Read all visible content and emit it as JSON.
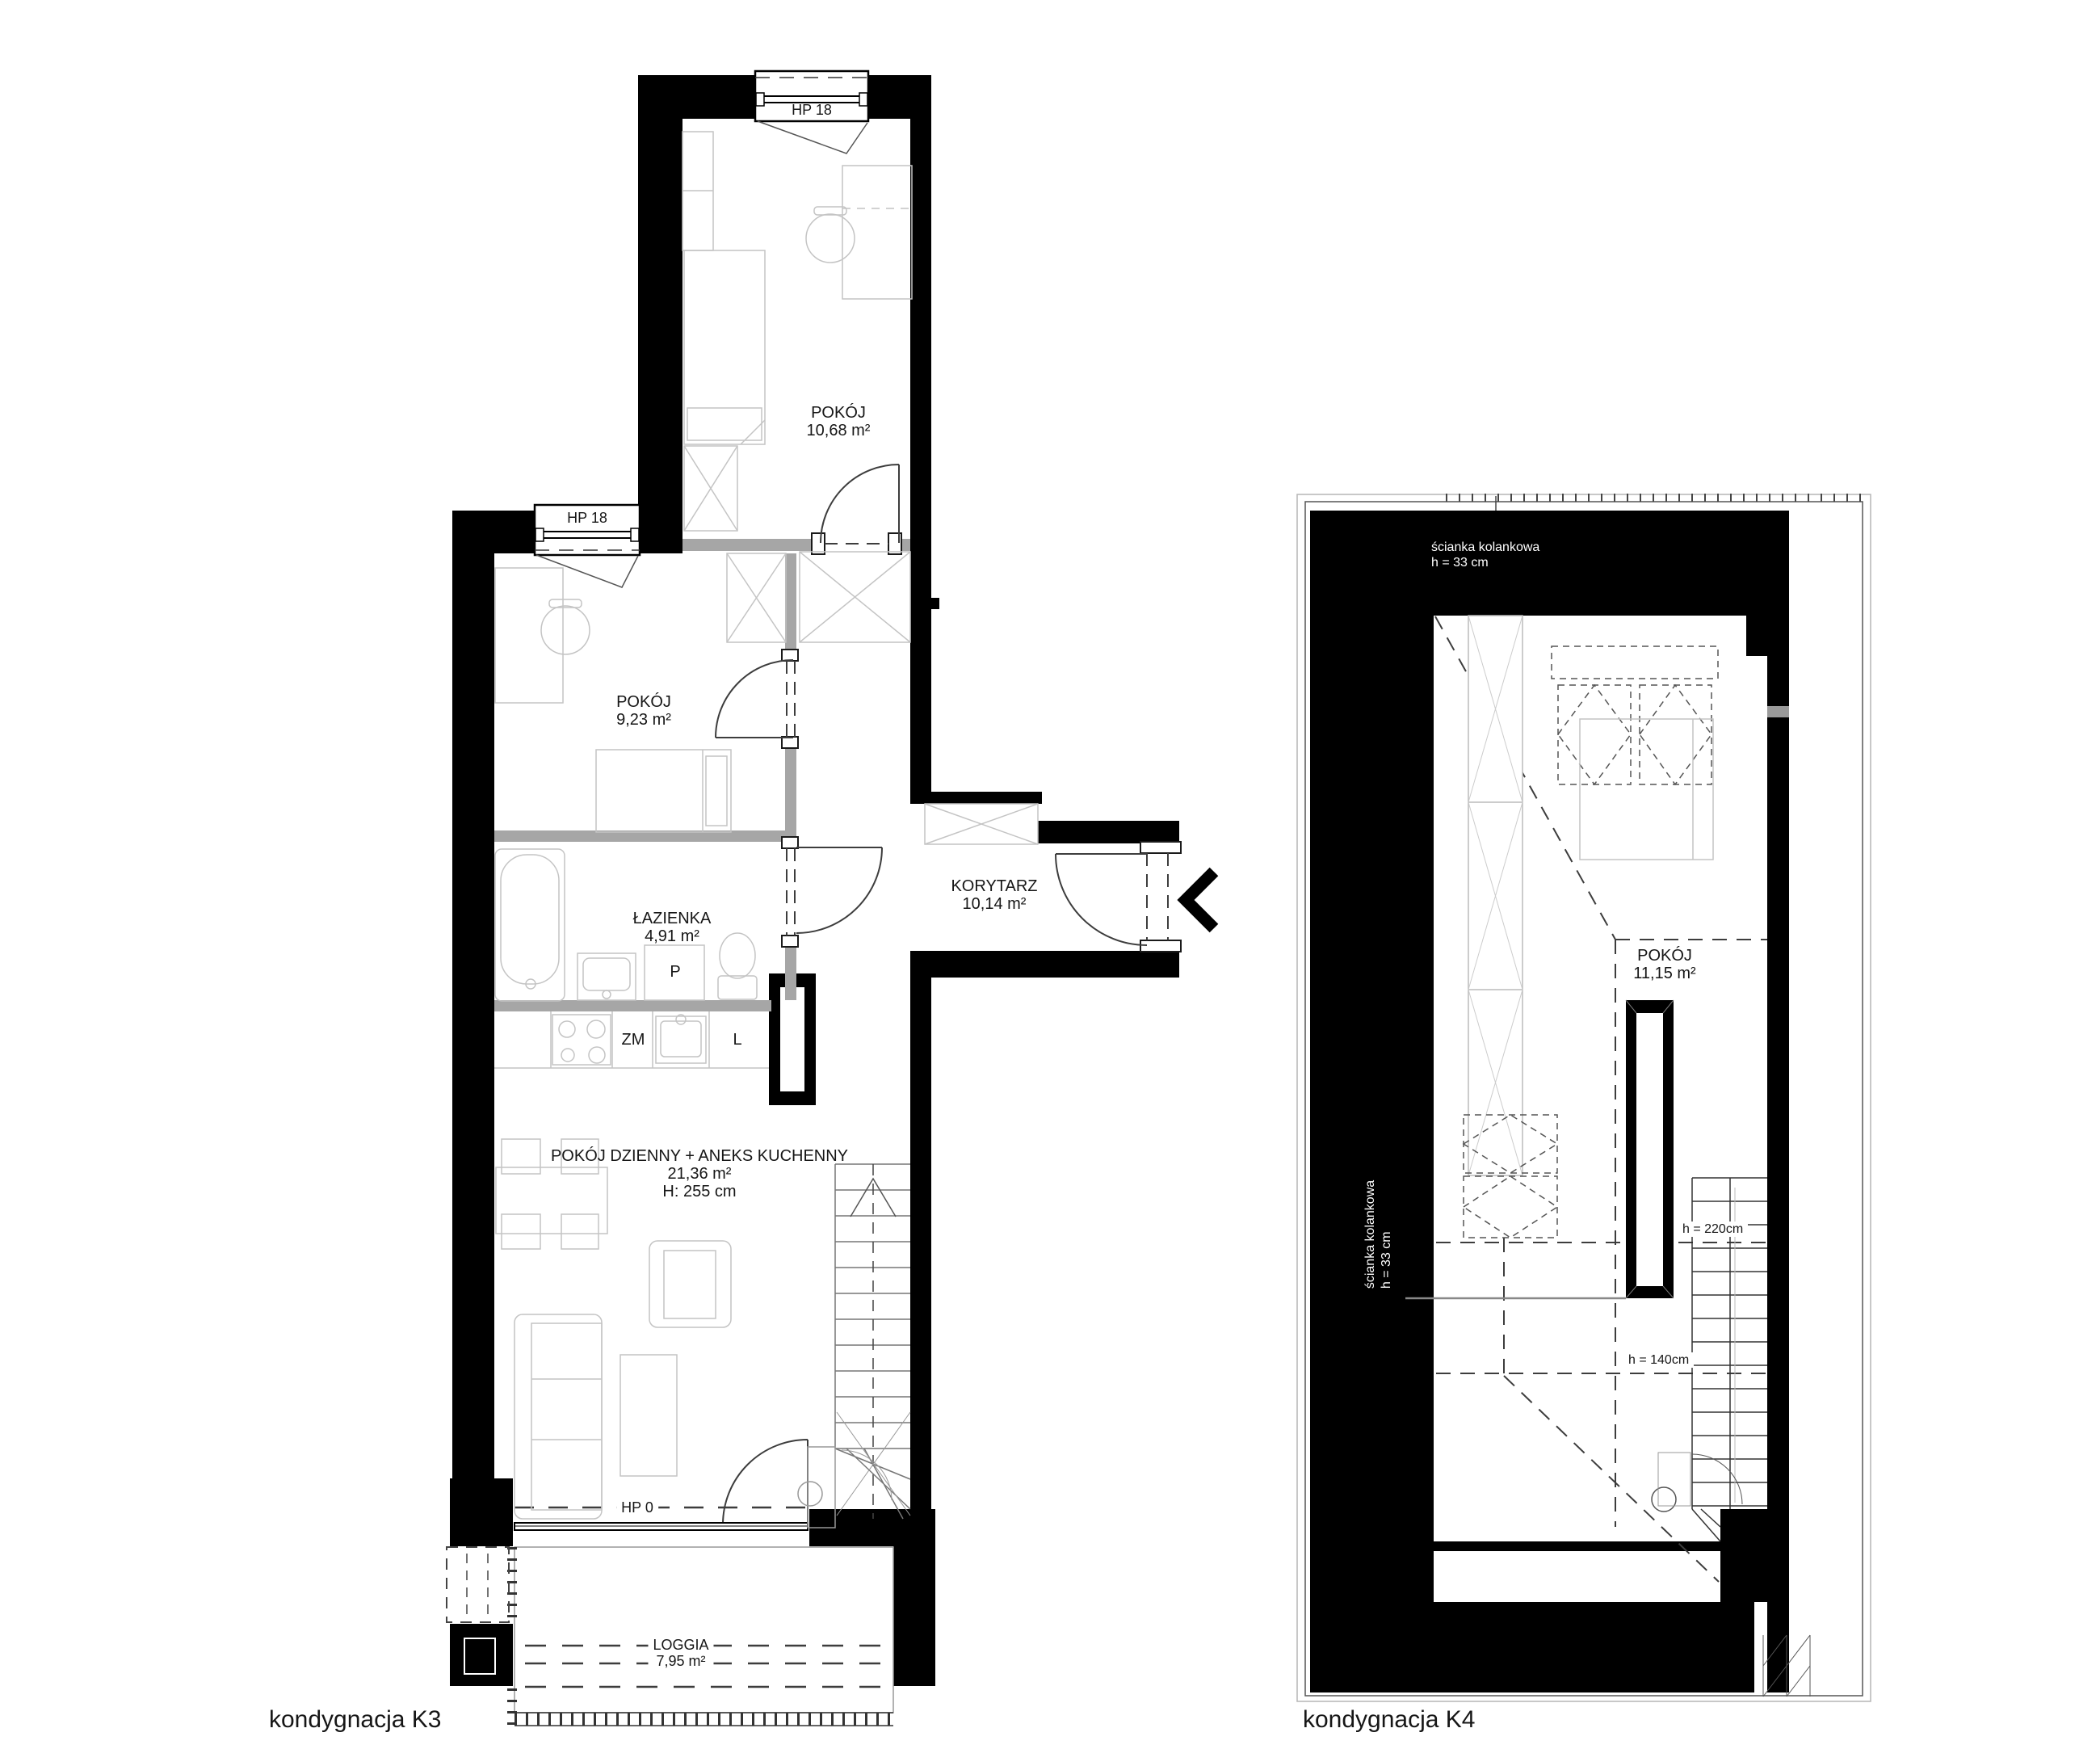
{
  "k3": {
    "floor_label": "kondygnacja K3",
    "rooms": {
      "pokoj_top": {
        "name": "POKÓJ",
        "area": "10,68 m²"
      },
      "pokoj_left": {
        "name": "POKÓJ",
        "area": "9,23 m²"
      },
      "lazienka": {
        "name": "ŁAZIENKA",
        "area": "4,91 m²"
      },
      "korytarz": {
        "name": "KORYTARZ",
        "area": "10,14 m²"
      },
      "pokoj_dzienny": {
        "name": "POKÓJ DZIENNY + ANEKS KUCHENNY",
        "area": "21,36 m²",
        "ceiling_height": "H: 255 cm"
      },
      "loggia": {
        "name": "LOGGIA",
        "area": "7,95 m²"
      }
    },
    "windows": {
      "top": "HP 18",
      "left": "HP 18",
      "balcony": "HP 0"
    },
    "fixtures": {
      "washing_machine": "P",
      "dishwasher": "ZM",
      "fridge": "L"
    }
  },
  "k4": {
    "floor_label": "kondygnacja K4",
    "rooms": {
      "pokoj": {
        "name": "POKÓJ",
        "area": "11,15 m²"
      }
    },
    "knee_wall_top": {
      "name": "ścianka kolankowa",
      "height": "h = 33 cm"
    },
    "knee_wall_left": {
      "name": "ścianka kolankowa",
      "height": "h = 33 cm"
    },
    "height_marks": {
      "upper": "h = 220cm",
      "lower": "h = 140cm"
    }
  },
  "colors": {
    "wall": "#000000",
    "partition": "#a6a6a6",
    "furniture": "#c4c4c4",
    "dashes": "#3d3d3d",
    "background": "#ffffff"
  }
}
